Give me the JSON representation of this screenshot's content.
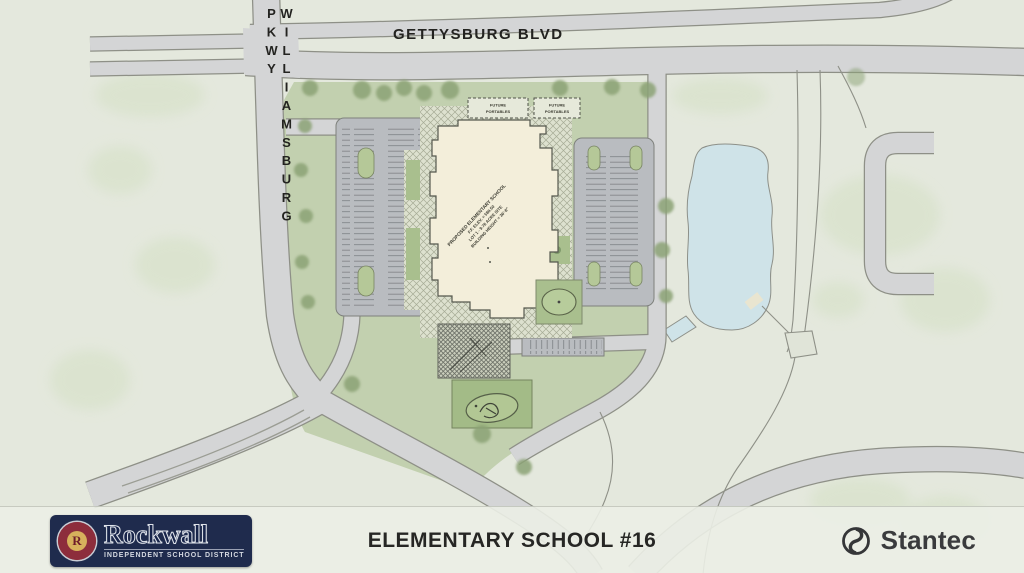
{
  "map": {
    "road_labels": {
      "gettysburg_blvd": "GETTYSBURG BLVD",
      "williamsburg_pkwy": "WILLIAMSBURG PKWY"
    },
    "building_label": {
      "line1": "PROPOSED ELEMENTARY SCHOOL",
      "line2": "F.F. ELEV. = 580.50",
      "line3": "LOT 1 - 9.78 ACRE SITE",
      "line4": "BUILDING HEIGHT = 36'-8\""
    },
    "future_portable": {
      "line1": "FUTURE",
      "line2": "PORTABLES"
    },
    "features": {
      "pond": "pond",
      "school_building": "proposed-school-building",
      "west_parking": "west-parking-lot",
      "east_parking": "east-parking-lot",
      "playground": "playground-area"
    }
  },
  "footer": {
    "project_title": "ELEMENTARY SCHOOL #16",
    "rockwall_logo": {
      "district_name": "Rockwall",
      "district_subtitle": "INDEPENDENT SCHOOL DISTRICT",
      "seal_letter": "R"
    },
    "stantec_logo": {
      "company_name": "Stantec"
    }
  },
  "colors": {
    "background": "#e4e8dd",
    "site_green": "#c2d0af",
    "tree_green": "#8ba275",
    "road_fill": "#d4d5d6",
    "road_edge": "#8e9087",
    "pond_blue": "#cfe3e8",
    "building_cream": "#f3eeda",
    "logo_navy": "#1f2b4d",
    "seal_maroon": "#82222f",
    "seal_gold": "#d7b15c",
    "stantec_charcoal": "#3a3b3d"
  }
}
